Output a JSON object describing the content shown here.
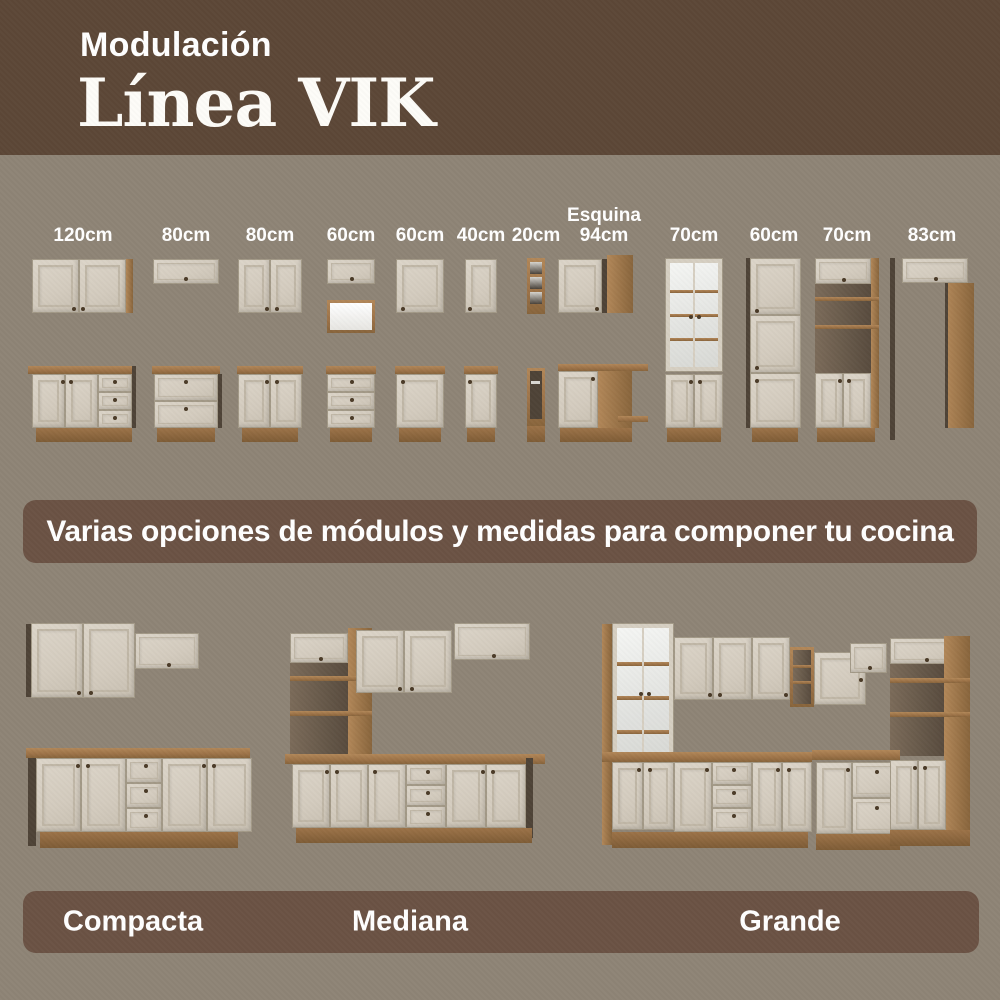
{
  "header": {
    "kicker": "Modulación",
    "title": "Línea VIK"
  },
  "modules": [
    {
      "size": "120cm"
    },
    {
      "size": "80cm"
    },
    {
      "size": "80cm"
    },
    {
      "size": "60cm"
    },
    {
      "size": "60cm"
    },
    {
      "size": "40cm"
    },
    {
      "size": "20cm"
    },
    {
      "prefix": "Esquina",
      "size": "94cm"
    },
    {
      "size": "70cm"
    },
    {
      "size": "60cm"
    },
    {
      "size": "70cm"
    },
    {
      "size": "83cm"
    }
  ],
  "banner": {
    "text": "Varias opciones de módulos y medidas para componer tu cocina"
  },
  "kitchens": [
    {
      "name": "Compacta"
    },
    {
      "name": "Mediana"
    },
    {
      "name": "Grande"
    }
  ],
  "colors": {
    "header_bg": "#5c4737",
    "panel_bg": "#6b5244",
    "body_bg": "#8e8476",
    "cabinet_cream": "#d6cfc2",
    "wood": "#a0764b",
    "label_text": "#ffffff"
  }
}
